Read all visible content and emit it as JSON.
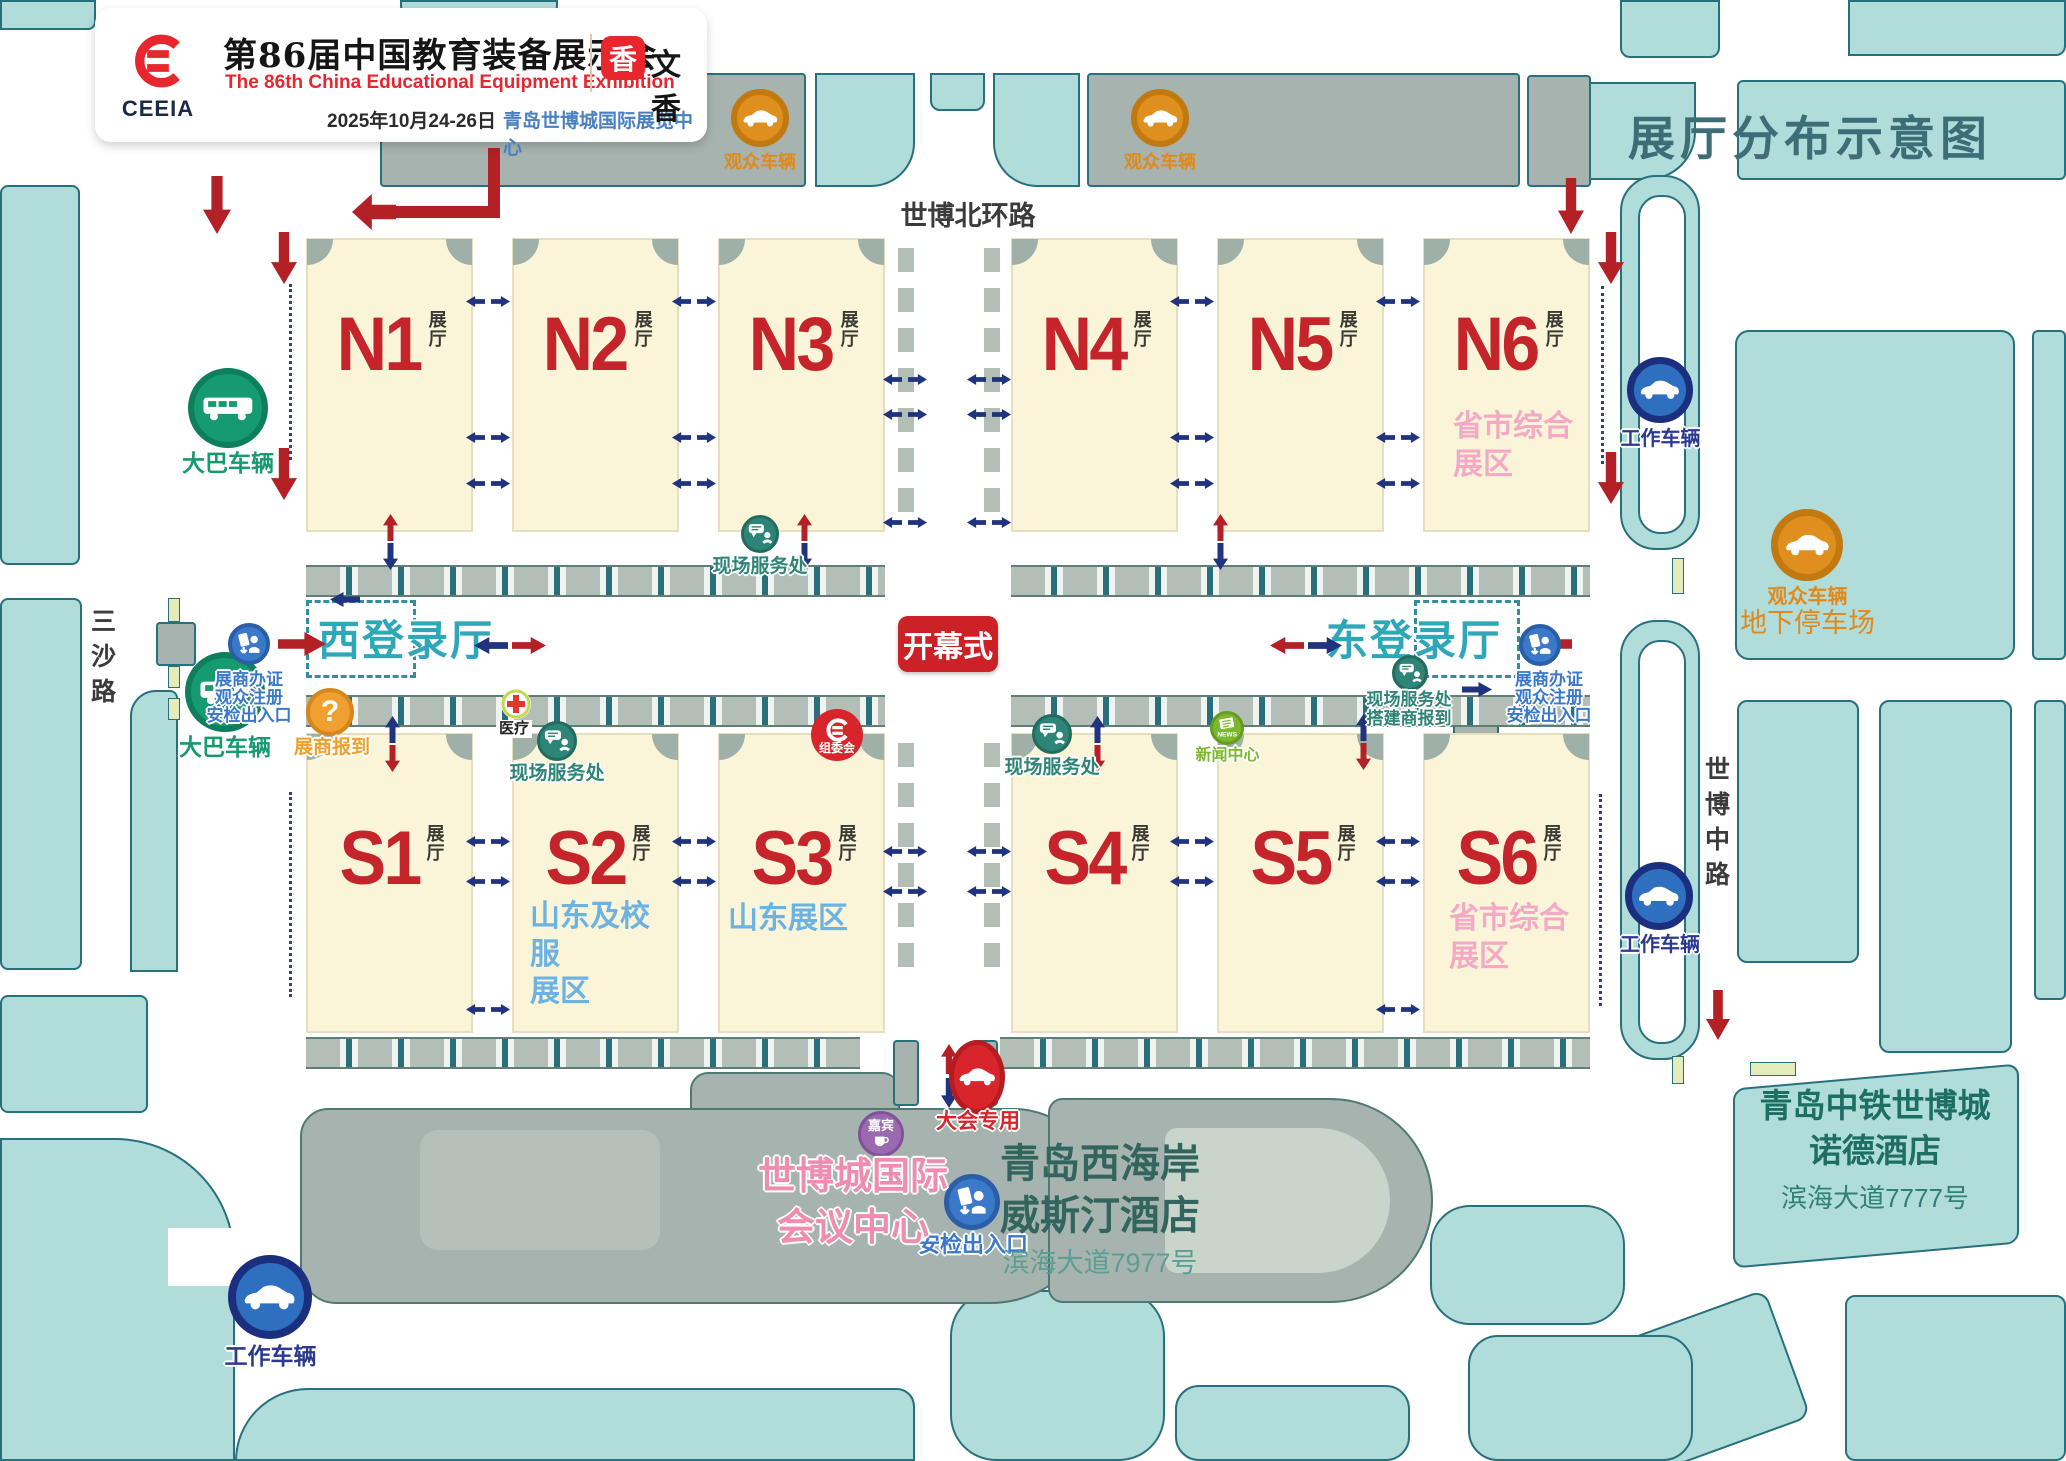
{
  "header": {
    "org": "CEEIA",
    "title_zh": "第86届中国教育装备展示会",
    "title_en": "The 86th China Educational Equipment Exhibition",
    "date": "2025年10月24-26日",
    "venue": "青岛世博城国际展览中心",
    "partner_name": "文香",
    "partner_glyph": "香"
  },
  "map_title": "展厅分布示意图",
  "roads": {
    "north": "世博北环路",
    "west": "三沙路",
    "east": "世博中路"
  },
  "halls": {
    "n1": {
      "num": "N1",
      "suffix": "展厅"
    },
    "n2": {
      "num": "N2",
      "suffix": "展厅"
    },
    "n3": {
      "num": "N3",
      "suffix": "展厅"
    },
    "n4": {
      "num": "N4",
      "suffix": "展厅"
    },
    "n5": {
      "num": "N5",
      "suffix": "展厅"
    },
    "n6": {
      "num": "N6",
      "suffix": "展厅",
      "subtitle": "省市综合\n展区"
    },
    "s1": {
      "num": "S1",
      "suffix": "展厅"
    },
    "s2": {
      "num": "S2",
      "suffix": "展厅",
      "subtitle": "山东及校服\n展区"
    },
    "s3": {
      "num": "S3",
      "suffix": "展厅",
      "subtitle": "山东展区"
    },
    "s4": {
      "num": "S4",
      "suffix": "展厅"
    },
    "s5": {
      "num": "S5",
      "suffix": "展厅"
    },
    "s6": {
      "num": "S6",
      "suffix": "展厅",
      "subtitle": "省市综合\n展区"
    }
  },
  "labels": {
    "opening": "开幕式",
    "west_hall": "西登录厅",
    "east_hall": "东登录厅",
    "bus": "大巴车辆",
    "work_vehicle": "工作车辆",
    "visitor_vehicle": "观众车辆",
    "underground": "地下停车场",
    "badge": "展商办证\n观众注册\n安检出入口",
    "checkin": "展商报到",
    "medical": "医疗",
    "service": "现场服务处",
    "service_builder": "现场服务处\n搭建商报到",
    "organizer": "组委会",
    "news": "新闻中心",
    "news_en": "NEWS",
    "guest": "嘉宾",
    "security": "安检出入口",
    "event_car": "大会专用",
    "conference_center": "世博城国际\n会议中心",
    "westin": "青岛西海岸\n威斯汀酒店",
    "westin_addr": "滨海大道7977号",
    "nord": "青岛中铁世博城\n诺德酒店",
    "nord_addr": "滨海大道7777号"
  },
  "colors": {
    "hall_red": "#c5242b",
    "teal_hall_text": "#2ea7b8",
    "pink_zone": "#f4a9c6",
    "blue_zone": "#6cb2e2",
    "bus_green": "#169a6f",
    "work_navy": "#2b3990",
    "visitor_orange": "#e08a1d",
    "service_teal": "#2e8577",
    "badge_blue": "#3a78c9",
    "red_accent": "#d7252b",
    "city_block": "#b0dcda",
    "hall_fill": "#faf5d8"
  }
}
